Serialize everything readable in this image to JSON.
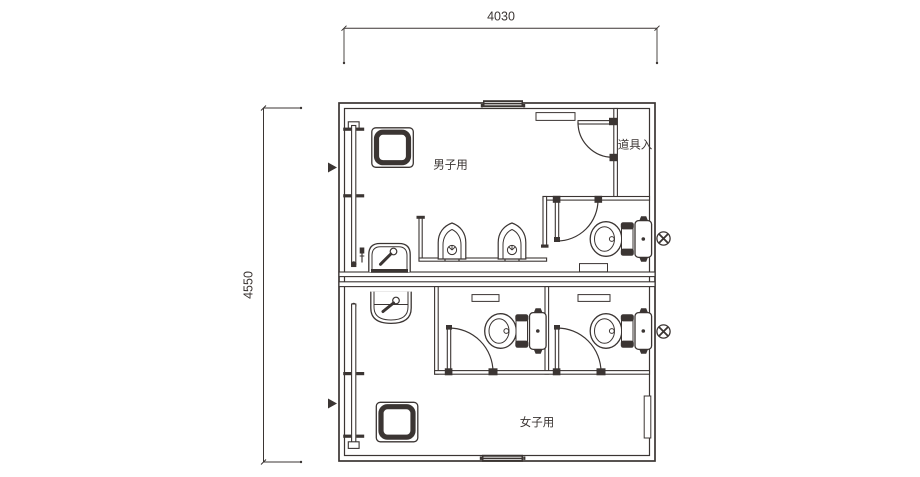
{
  "page": {
    "background": "#ffffff"
  },
  "drawing": {
    "line_color": "#3b3533",
    "labels": {
      "room_top": "男子用",
      "room_bottom": "女子用",
      "storage": "道具入"
    },
    "dimensions": {
      "width_mm": "4030",
      "height_mm": "4550"
    },
    "fixtures": {
      "toilet_icon_count": 3,
      "urinal_icon_count": 2,
      "hand_basin_icon_count": 2,
      "cleaning_sink_icon_count": 2,
      "vent_fan_icon_count": 2,
      "entrance_arrow_count": 2
    }
  }
}
